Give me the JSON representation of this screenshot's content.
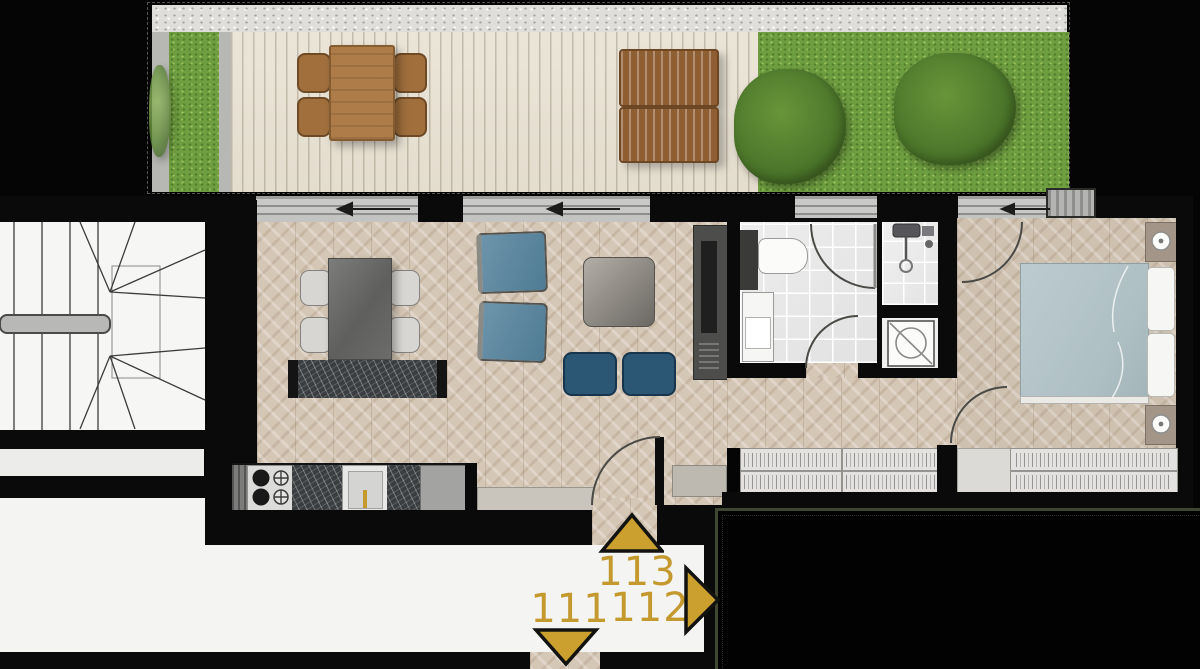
{
  "plan": {
    "markers": {
      "current_unit": {
        "label": "113",
        "direction": "up"
      },
      "unit_down": {
        "label": "111",
        "direction": "down"
      },
      "unit_right": {
        "label": "112",
        "direction": "right"
      }
    },
    "colors": {
      "gold": "#c49a2e",
      "wall": "#0a0a0a",
      "floor-wood": "#d5c7b5",
      "floor-deck": "#ebe5d8",
      "gravel": "#dfdedb",
      "grass": "#6f9e41",
      "corridor": "#f4f4f3",
      "marble": "#3a3e40",
      "blue-chair": "#5c88a1",
      "pouf-blue": "#2b5775",
      "bed-duvet": "#b5c6cb",
      "outdoor-wood": "#ad7c48",
      "adjacent-unit-border": "#3f4632"
    }
  }
}
